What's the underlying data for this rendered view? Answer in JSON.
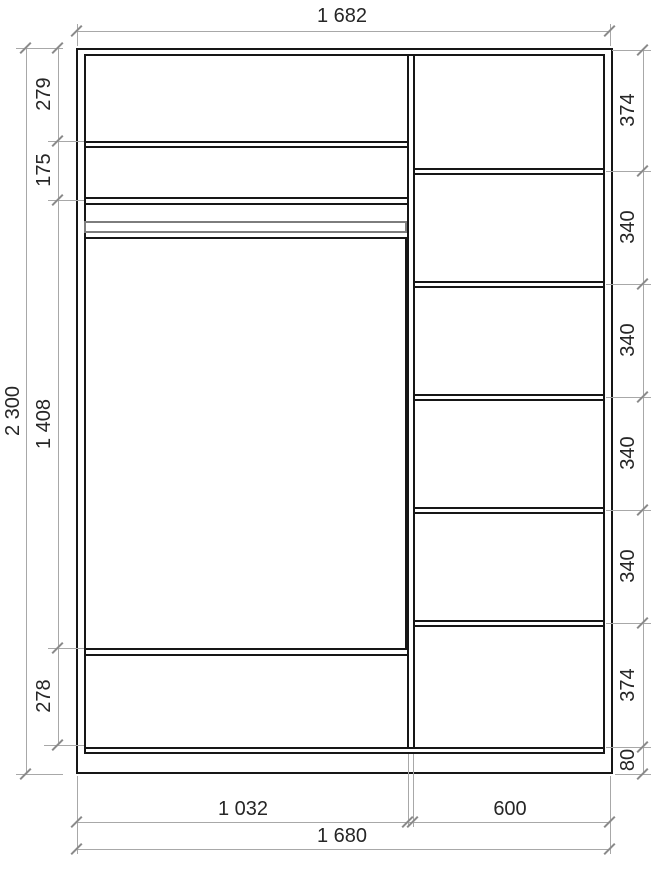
{
  "drawing": {
    "kind": "wardrobe-front-elevation-technical-drawing",
    "dimensions": {
      "overall_width_top": "1 682",
      "overall_height_left": "2 300",
      "left_column_segments": [
        "279",
        "175",
        "1 408",
        "278"
      ],
      "right_column_segments": [
        "374",
        "340",
        "340",
        "340",
        "340",
        "374",
        "80"
      ],
      "bottom_inner_segments": [
        "1 032",
        "600"
      ],
      "bottom_overall_width": "1 680"
    },
    "colors": {
      "outline": "#161616",
      "dimension_line": "#a8a8a8",
      "tick": "#8a8a8a",
      "text": "#262626",
      "clothes_rail": "#7d7d7d",
      "background": "#ffffff"
    }
  }
}
